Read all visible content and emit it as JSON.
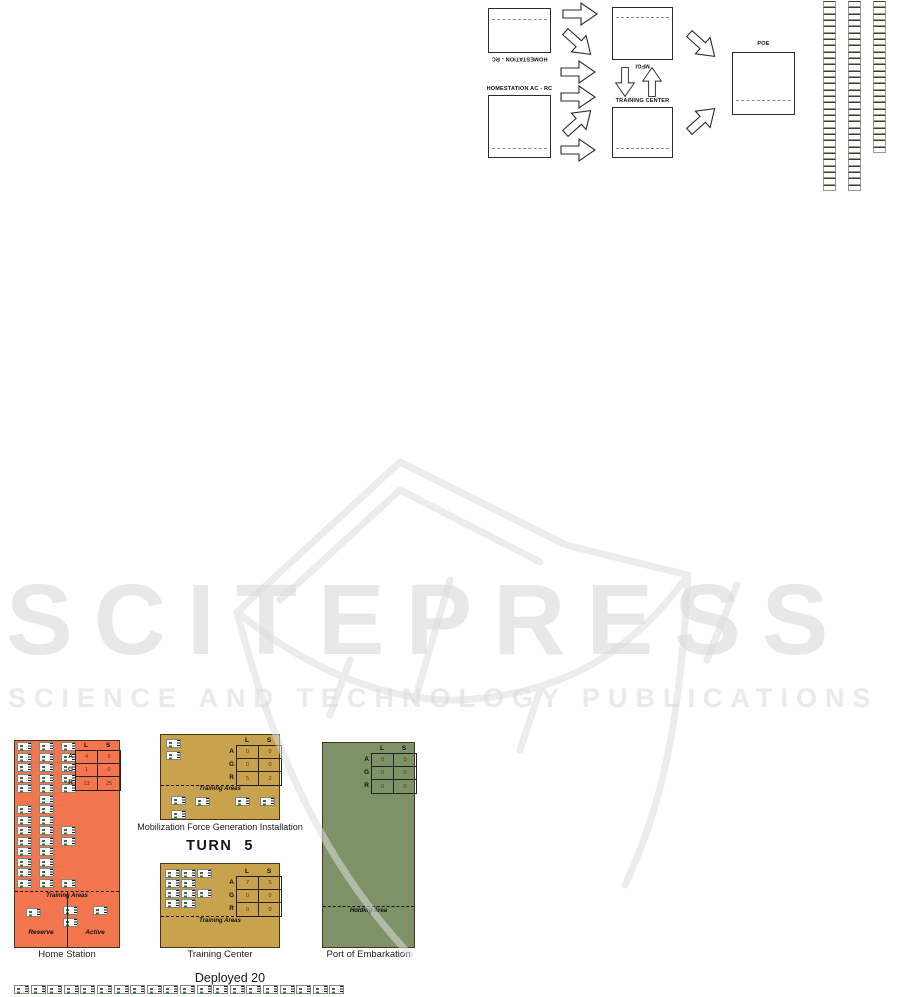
{
  "watermark": {
    "title": "SCITEPRESS",
    "subtitle": "SCIENCE AND TECHNOLOGY PUBLICATIONS"
  },
  "flow_diagram": {
    "homestation_rc_label": "HOMESTATION - RC",
    "homestation_ac_rc_label": "HOMESTATION AC - RC",
    "mfgi_label": "MFGI",
    "training_center_label": "TRAINING CENTER",
    "poe_label": "POE",
    "ladders": [
      {
        "cells": 30
      },
      {
        "cells": 30
      },
      {
        "cells": 24
      }
    ]
  },
  "turn": {
    "label": "TURN",
    "value": "5"
  },
  "deployed": {
    "label": "Deployed 20",
    "count": 20
  },
  "panels": {
    "home_station": {
      "caption": "Home Station",
      "training_areas_label": "Training Areas",
      "reserve_label": "Reserve",
      "active_label": "Active",
      "table": {
        "cols": [
          "L",
          "S"
        ],
        "rows": [
          "A",
          "G",
          "R"
        ],
        "values": [
          [
            "4",
            "9"
          ],
          [
            "1",
            "0"
          ],
          [
            "13",
            "25"
          ]
        ]
      },
      "units": [
        [
          2,
          1
        ],
        [
          24,
          1
        ],
        [
          46,
          1
        ],
        [
          2,
          12
        ],
        [
          24,
          12
        ],
        [
          46,
          12
        ],
        [
          2,
          22
        ],
        [
          24,
          22
        ],
        [
          46,
          22
        ],
        [
          2,
          33
        ],
        [
          24,
          33
        ],
        [
          46,
          33
        ],
        [
          2,
          43
        ],
        [
          24,
          43
        ],
        [
          46,
          43
        ],
        [
          24,
          54
        ],
        [
          2,
          64
        ],
        [
          24,
          64
        ],
        [
          2,
          75
        ],
        [
          24,
          75
        ],
        [
          2,
          85
        ],
        [
          24,
          85
        ],
        [
          46,
          85
        ],
        [
          2,
          96
        ],
        [
          24,
          96
        ],
        [
          46,
          96
        ],
        [
          2,
          106
        ],
        [
          24,
          106
        ],
        [
          2,
          117
        ],
        [
          24,
          117
        ],
        [
          2,
          127
        ],
        [
          24,
          127
        ],
        [
          2,
          138
        ],
        [
          24,
          138
        ],
        [
          46,
          138
        ]
      ],
      "training_units": [
        [
          11,
          167
        ],
        [
          48,
          165
        ],
        [
          48,
          177
        ],
        [
          78,
          165
        ]
      ]
    },
    "mfgi": {
      "caption": "Mobilization Force Generation Installation",
      "training_areas_label": "Training Areas",
      "table": {
        "cols": [
          "L",
          "S"
        ],
        "rows": [
          "A",
          "G",
          "R"
        ],
        "values": [
          [
            "0",
            "0"
          ],
          [
            "0",
            "0"
          ],
          [
            "5",
            "2"
          ]
        ]
      },
      "units": [
        [
          5,
          4
        ],
        [
          5,
          16
        ]
      ],
      "training_units": [
        [
          10,
          61
        ],
        [
          34,
          62
        ],
        [
          74,
          62
        ],
        [
          99,
          62
        ],
        [
          10,
          75
        ]
      ]
    },
    "training_center": {
      "caption": "Training Center",
      "training_areas_label": "Training Areas",
      "table": {
        "cols": [
          "L",
          "S"
        ],
        "rows": [
          "A",
          "G",
          "R"
        ],
        "values": [
          [
            "7",
            "5"
          ],
          [
            "0",
            "0"
          ],
          [
            "0",
            "0"
          ]
        ]
      },
      "units": [
        [
          4,
          5
        ],
        [
          20,
          5
        ],
        [
          36,
          5
        ],
        [
          4,
          15
        ],
        [
          20,
          15
        ],
        [
          4,
          25
        ],
        [
          20,
          25
        ],
        [
          36,
          25
        ],
        [
          4,
          35
        ],
        [
          20,
          35
        ]
      ]
    },
    "poe": {
      "caption": "Port of Embarkation",
      "holding_area_label": "Holding Area",
      "table": {
        "cols": [
          "L",
          "S"
        ],
        "rows": [
          "A",
          "G",
          "R"
        ],
        "values": [
          [
            "0",
            "0"
          ],
          [
            "0",
            "0"
          ],
          [
            "0",
            "0"
          ]
        ]
      }
    }
  },
  "colors": {
    "home_station_bg": "#f4764f",
    "installation_bg": "#c8a24d",
    "poe_bg": "#7d9266",
    "watermark_gray": "#e8e8e8"
  }
}
